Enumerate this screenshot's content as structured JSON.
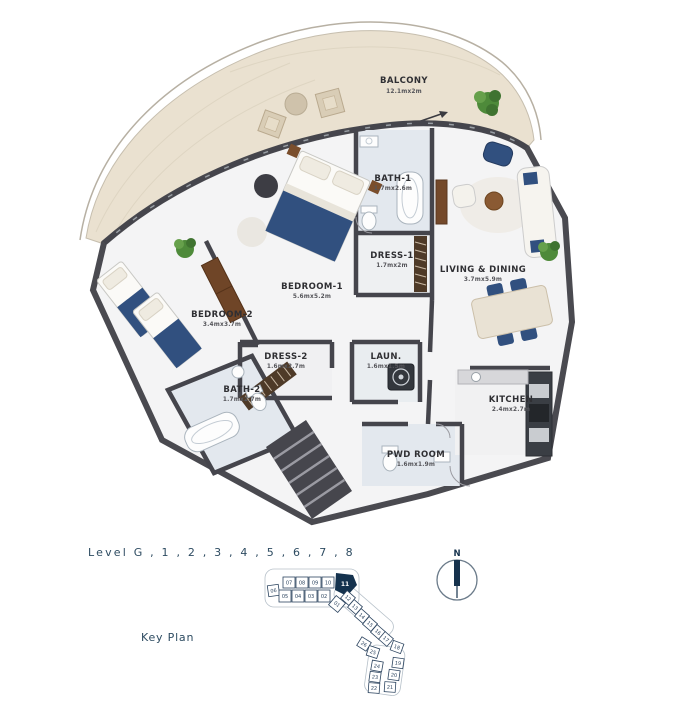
{
  "page": {
    "background": "#ffffff"
  },
  "floor_plan": {
    "rooms": [
      {
        "id": "balcony",
        "name": "BALCONY",
        "dims": "12.1mx2m"
      },
      {
        "id": "bath1",
        "name": "BATH-1",
        "dims": "1.7mx2.6m"
      },
      {
        "id": "dress1",
        "name": "DRESS-1",
        "dims": "1.7mx2m"
      },
      {
        "id": "living",
        "name": "LIVING & DINING",
        "dims": "3.7mx5.9m"
      },
      {
        "id": "bedroom1",
        "name": "BEDROOM-1",
        "dims": "5.6mx5.2m"
      },
      {
        "id": "bedroom2",
        "name": "BEDROOM-2",
        "dims": "3.4mx3.7m"
      },
      {
        "id": "dress2",
        "name": "DRESS-2",
        "dims": "1.6mx2.7m"
      },
      {
        "id": "laundry",
        "name": "LAUN.",
        "dims": "1.6mx1.5m"
      },
      {
        "id": "bath2",
        "name": "BATH-2",
        "dims": "1.7mx2.7m"
      },
      {
        "id": "pwd",
        "name": "PWD ROOM",
        "dims": "1.6mx1.9m"
      },
      {
        "id": "kitchen",
        "name": "KITCHEN",
        "dims": "2.4mx2.7m"
      }
    ]
  },
  "footer": {
    "level_label": "Level G , 1 , 2 , 3 , 4 , 5 , 6 , 7 , 8",
    "key_plan_label": "Key Plan",
    "north_label": "N"
  },
  "key_plan": {
    "highlighted_unit": "11",
    "units": [
      "01",
      "02",
      "03",
      "04",
      "05",
      "06",
      "07",
      "08",
      "09",
      "10",
      "11",
      "12",
      "13",
      "14",
      "15",
      "16",
      "17",
      "18",
      "19",
      "20",
      "21",
      "22",
      "23",
      "24",
      "25",
      "26"
    ]
  },
  "colors": {
    "wall": "#4a4a50",
    "balcony_floor": "#eae1d0",
    "bath_floor": "#e3e8ee",
    "furniture_navy": "#31507f",
    "wood": "#6f4527",
    "plant_green": "#4e8a3a",
    "accent_navy": "#16324d",
    "label_teal": "#2d4b61",
    "room_text": "#2f2f33"
  }
}
